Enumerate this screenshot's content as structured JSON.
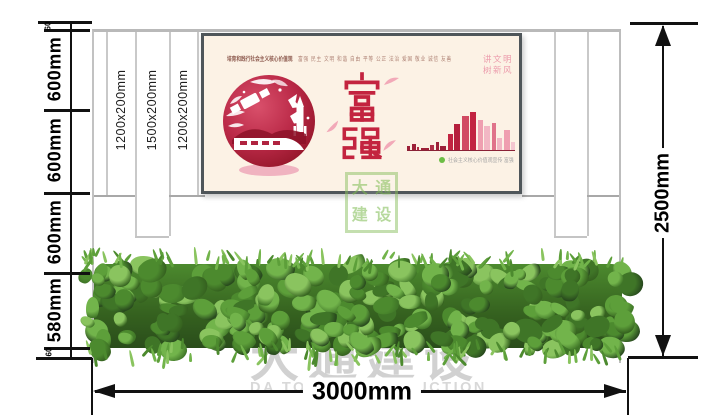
{
  "dimensions": {
    "left_segments": [
      "60",
      "600mm",
      "600mm",
      "600mm",
      "580mm",
      "60"
    ],
    "pillar_labels": [
      "1200x200mm",
      "1500x200mm",
      "1200x200mm"
    ],
    "height_total": "2500mm",
    "width_total": "3000mm"
  },
  "poster": {
    "tagline_title": "培育和践行社会主义核心价值观",
    "tagline_values": "富强 民主 文明 和谐 自由 平等 公正 法治 爱国 敬业 诚信 友善",
    "headline": "富强",
    "slogan_line1": "讲文明",
    "slogan_line2": "树新风",
    "caption": "社会主义核心价值观宣传 富强",
    "skyline_bars": [
      [
        3,
        4,
        "#9d2038"
      ],
      [
        4,
        6,
        "#9d2038"
      ],
      [
        2,
        3,
        "#b03048"
      ],
      [
        8,
        2,
        "#9d2038"
      ],
      [
        4,
        5,
        "#b03048"
      ],
      [
        3,
        8,
        "#9d2038"
      ],
      [
        6,
        4,
        "#9d2038"
      ],
      [
        5,
        16,
        "#c22441"
      ],
      [
        6,
        26,
        "#b51f3c"
      ],
      [
        7,
        34,
        "#d14a62"
      ],
      [
        6,
        38,
        "#c22441"
      ],
      [
        5,
        30,
        "#ef9fb0"
      ],
      [
        6,
        24,
        "#f2b7c4"
      ],
      [
        4,
        27,
        "#e0738a"
      ],
      [
        5,
        12,
        "#f2b7c4"
      ],
      [
        6,
        20,
        "#ef9fb0"
      ],
      [
        4,
        8,
        "#f4c6d0"
      ]
    ]
  },
  "watermark": {
    "logo_char1": "大",
    "logo_char2": "通",
    "logo_char3": "建",
    "logo_char4": "设",
    "brand_cn": "大通建设",
    "brand_en": "DA TONG CONSTRUCTION"
  },
  "colors": {
    "poster_bg": "#fcf2e5",
    "poster_frame": "#4f565a",
    "headline_red": "#c3243f",
    "slogan_pink": "#ec9cac",
    "watermark_green": "#7cb94e",
    "watermark_gray": "#c9c9c9",
    "dimension_black": "#111111",
    "hedge": [
      "#27471d",
      "#35611f",
      "#3f7527",
      "#4c8a2e",
      "#5d9f3a",
      "#72b44b",
      "#8ac45f"
    ]
  }
}
